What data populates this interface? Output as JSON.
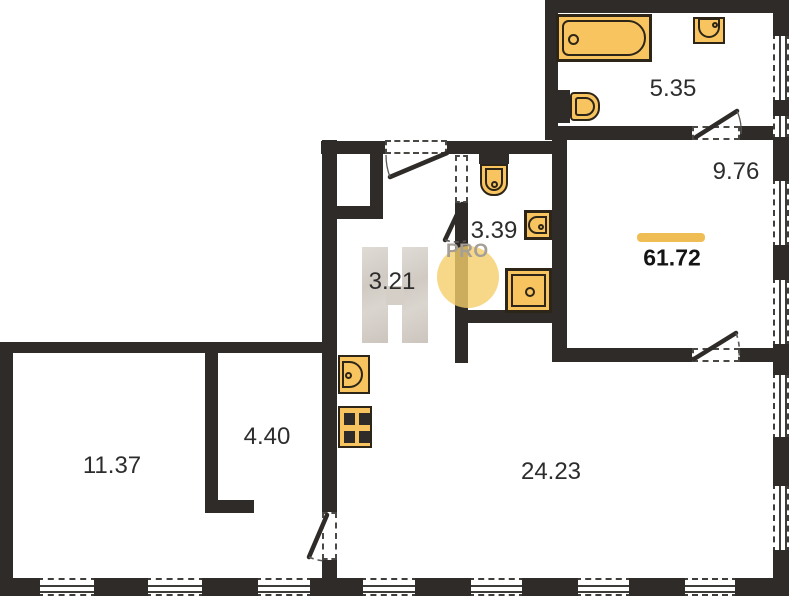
{
  "watermark": {
    "letter": "H",
    "badge": "PRO"
  },
  "total_area": {
    "value": "61.72"
  },
  "rooms": {
    "bathroom": {
      "area": "5.35"
    },
    "bedroom": {
      "area": "9.76"
    },
    "wc": {
      "area": "3.39"
    },
    "hallway": {
      "area": "3.21"
    },
    "living_room": {
      "area": "11.37"
    },
    "wardrobe": {
      "area": "4.40"
    },
    "kitchen_living": {
      "area": "24.23"
    }
  },
  "fixtures": {
    "bathroom": [
      "bathtub-icon",
      "washbasin-icon",
      "toilet-icon"
    ],
    "wc": [
      "toilet-icon",
      "washbasin-icon",
      "shower-icon"
    ],
    "kitchen": [
      "kitchen-sink-icon",
      "stove-icon"
    ]
  },
  "colors": {
    "wall": "#2e2b28",
    "fixture_fill": "#f7c45f",
    "fixture_border": "#2e2519",
    "accent_bar": "#f0bd55",
    "watermark_circle": "#f4ce6a",
    "watermark_letter": "#d5cfc8",
    "watermark_text": "#a59f98",
    "label_text": "#2d2d2d"
  }
}
